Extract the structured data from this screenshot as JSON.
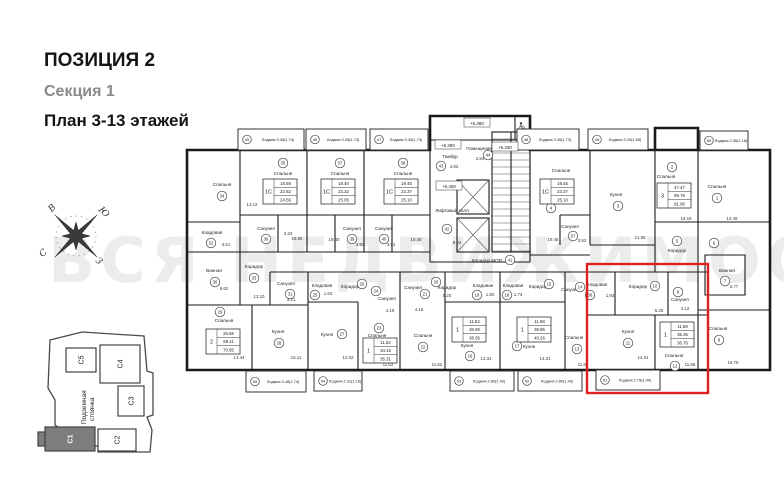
{
  "header": {
    "position": "ПОЗИЦИЯ 2",
    "section": "Секция 1",
    "plan_title": "План 3-13 этажей"
  },
  "watermark": "ВСЯ НЕДВИЖИМОСТЬ",
  "compass": {
    "north": "С",
    "east": "В",
    "south": "Ю",
    "west": "З"
  },
  "site_plan": {
    "parking_line1": "Подземная",
    "parking_line2": "стоянка",
    "highlighted": "С1",
    "sections": [
      {
        "id": "С5",
        "x": 66,
        "y": 348,
        "w": 30,
        "h": 24,
        "dark": false
      },
      {
        "id": "С4",
        "x": 100,
        "y": 345,
        "w": 40,
        "h": 38,
        "dark": false
      },
      {
        "id": "С3",
        "x": 118,
        "y": 386,
        "w": 26,
        "h": 30,
        "dark": false
      },
      {
        "id": "С2",
        "x": 98,
        "y": 429,
        "w": 38,
        "h": 22,
        "dark": false
      },
      {
        "id": "С1",
        "x": 45,
        "y": 427,
        "w": 50,
        "h": 24,
        "dark": true
      }
    ]
  },
  "plan": {
    "highlight_color": "#e02020",
    "loggia_word": "Лоджия",
    "highlight": {
      "x": 587,
      "y": 264,
      "w": 121,
      "h": 129
    },
    "elevations": [
      {
        "t": "+6.380",
        "x": 477,
        "y": 124
      },
      {
        "t": "+6.390",
        "x": 448,
        "y": 146
      },
      {
        "t": "+6.330",
        "x": 505,
        "y": 148
      },
      {
        "t": "+6.400",
        "x": 449,
        "y": 187
      }
    ],
    "rooms": [
      {
        "n": "Спальня",
        "tx": 222,
        "ty": 186,
        "m": "34",
        "cx": 222,
        "cy": 196
      },
      {
        "n": "Спальня",
        "tx": 283,
        "ty": 175,
        "m": "35",
        "cx": 283,
        "cy": 163
      },
      {
        "n": "Спальня",
        "tx": 340,
        "ty": 175,
        "m": "37",
        "cx": 340,
        "cy": 163
      },
      {
        "n": "Спальня",
        "tx": 403,
        "ty": 175,
        "m": "38",
        "cx": 403,
        "cy": 163
      },
      {
        "n": "Спальня",
        "tx": 561,
        "ty": 172,
        "m": "4",
        "cx": 551,
        "cy": 208
      },
      {
        "n": "Кухня",
        "tx": 616,
        "ty": 196,
        "m": "3",
        "cx": 618,
        "cy": 206
      },
      {
        "n": "Спальня",
        "tx": 666,
        "ty": 178,
        "m": "2",
        "cx": 672,
        "cy": 167
      },
      {
        "n": "Спальня",
        "tx": 717,
        "ty": 188,
        "m": "1",
        "cx": 717,
        "cy": 198
      },
      {
        "n": "Кладовая",
        "tx": 212,
        "ty": 234,
        "m": "32",
        "cx": 211,
        "cy": 243
      },
      {
        "n": "Ванная",
        "tx": 214,
        "ty": 272,
        "m": "30",
        "cx": 215,
        "cy": 282
      },
      {
        "n": "Коридор",
        "tx": 254,
        "ty": 268,
        "m": "33",
        "cx": 254,
        "cy": 278
      },
      {
        "n": "Санузел",
        "tx": 266,
        "ty": 230,
        "m": "36",
        "cx": 266,
        "cy": 239
      },
      {
        "n": "Санузел",
        "tx": 352,
        "ty": 230,
        "m": "39",
        "cx": 352,
        "cy": 239
      },
      {
        "n": "Санузел",
        "tx": 384,
        "ty": 230,
        "m": "40",
        "cx": 384,
        "cy": 239
      },
      {
        "n": "Санузел",
        "tx": 570,
        "ty": 228,
        "m": "57",
        "cx": 573,
        "cy": 236
      },
      {
        "n": "Тамбур",
        "tx": 450,
        "ty": 158,
        "m": "43",
        "cx": 441,
        "cy": 166
      },
      {
        "n": "Помещение",
        "tx": 479,
        "ty": 150,
        "m": "44",
        "cx": 488,
        "cy": 155
      },
      {
        "n": "Лифтовый холл",
        "tx": 452,
        "ty": 212,
        "m": "42",
        "cx": 447,
        "cy": 229
      },
      {
        "n": "Коридор МОП",
        "tx": 487,
        "ty": 262,
        "m": "41",
        "cx": 510,
        "cy": 260
      },
      {
        "n": "Коридор",
        "tx": 677,
        "ty": 252,
        "m": "5",
        "cx": 677,
        "cy": 241
      },
      {
        "n": "",
        "tx": 714,
        "ty": 240,
        "m": "6",
        "cx": 714,
        "cy": 243
      },
      {
        "n": "Ванная",
        "tx": 727,
        "ty": 272,
        "m": "7",
        "cx": 725,
        "cy": 281
      },
      {
        "n": "Спальня",
        "tx": 224,
        "ty": 322,
        "m": "29",
        "cx": 220,
        "cy": 312
      },
      {
        "n": "Кухня",
        "tx": 278,
        "ty": 333,
        "m": "28",
        "cx": 279,
        "cy": 343
      },
      {
        "n": "Санузел",
        "tx": 286,
        "ty": 285,
        "m": "31",
        "cx": 290,
        "cy": 294
      },
      {
        "n": "Кладовая",
        "tx": 322,
        "ty": 287,
        "m": "25",
        "cx": 315,
        "cy": 295
      },
      {
        "n": "Коридор",
        "tx": 350,
        "ty": 288,
        "m": "26",
        "cx": 362,
        "cy": 284
      },
      {
        "n": "Кухня",
        "tx": 327,
        "ty": 336,
        "m": "27",
        "cx": 342,
        "cy": 334
      },
      {
        "n": "Спальня",
        "tx": 377,
        "ty": 337,
        "m": "23",
        "cx": 379,
        "cy": 328
      },
      {
        "n": "Санузел",
        "tx": 387,
        "ty": 300,
        "m": "24",
        "cx": 376,
        "cy": 291
      },
      {
        "n": "Спальня",
        "tx": 423,
        "ty": 337,
        "m": "22",
        "cx": 423,
        "cy": 347
      },
      {
        "n": "Санузел",
        "tx": 413,
        "ty": 289,
        "m": "21",
        "cx": 425,
        "cy": 294
      },
      {
        "n": "Коридор",
        "tx": 447,
        "ty": 289,
        "m": "20",
        "cx": 436,
        "cy": 282
      },
      {
        "n": "Кладовая",
        "tx": 483,
        "ty": 287,
        "m": "19",
        "cx": 477,
        "cy": 295
      },
      {
        "n": "Кухня",
        "tx": 467,
        "ty": 347,
        "m": "18",
        "cx": 470,
        "cy": 356
      },
      {
        "n": "Кладовая",
        "tx": 513,
        "ty": 287,
        "m": "16",
        "cx": 507,
        "cy": 295
      },
      {
        "n": "Коридор",
        "tx": 538,
        "ty": 288,
        "m": "15",
        "cx": 549,
        "cy": 284
      },
      {
        "n": "Кухня",
        "tx": 529,
        "ty": 348,
        "m": "17",
        "cx": 517,
        "cy": 346
      },
      {
        "n": "Санузел",
        "tx": 570,
        "ty": 291,
        "m": "14",
        "cx": 580,
        "cy": 287
      },
      {
        "n": "Спальня",
        "tx": 574,
        "ty": 339,
        "m": "13",
        "cx": 577,
        "cy": 349
      },
      {
        "n": "Кладовая",
        "tx": 597,
        "ty": 286,
        "m": "56",
        "cx": 590,
        "cy": 295
      },
      {
        "n": "Коридор",
        "tx": 638,
        "ty": 288,
        "m": "10",
        "cx": 655,
        "cy": 286
      },
      {
        "n": "Санузел",
        "tx": 680,
        "ty": 301,
        "m": "9",
        "cx": 678,
        "cy": 292
      },
      {
        "n": "Кухня",
        "tx": 628,
        "ty": 333,
        "m": "11",
        "cx": 628,
        "cy": 343
      },
      {
        "n": "Спальня",
        "tx": 674,
        "ty": 357,
        "m": "12",
        "cx": 675,
        "cy": 366
      },
      {
        "n": "Спальня",
        "tx": 718,
        "ty": 330,
        "m": "8",
        "cx": 719,
        "cy": 340
      }
    ],
    "tables": [
      {
        "type": "1С",
        "rows": [
          "18.59",
          "22.82",
          "24.56"
        ],
        "x": 263,
        "y": 179
      },
      {
        "type": "1С",
        "rows": [
          "19.40",
          "23.32",
          "25.05"
        ],
        "x": 321,
        "y": 179
      },
      {
        "type": "1С",
        "rows": [
          "19.45",
          "23.37",
          "25.10"
        ],
        "x": 384,
        "y": 179
      },
      {
        "type": "1С",
        "rows": [
          "19.45",
          "23.37",
          "25.10"
        ],
        "x": 540,
        "y": 179
      },
      {
        "type": "3",
        "rows": [
          "47.47",
          "89.76",
          "91.95"
        ],
        "x": 657,
        "y": 183
      },
      {
        "type": "2",
        "rows": [
          "26.56",
          "69.11",
          "70.85"
        ],
        "x": 206,
        "y": 329
      },
      {
        "type": "1",
        "rows": [
          "11.52",
          "34.15",
          "35.31"
        ],
        "x": 363,
        "y": 338
      },
      {
        "type": "1",
        "rows": [
          "11.52",
          "36.96",
          "38.36"
        ],
        "x": 452,
        "y": 317
      },
      {
        "type": "1",
        "rows": [
          "11.68",
          "38.86",
          "40.26"
        ],
        "x": 517,
        "y": 317
      },
      {
        "type": "1",
        "rows": [
          "11.68",
          "35.36",
          "36.76"
        ],
        "x": 660,
        "y": 322
      }
    ],
    "loggias": [
      {
        "m": "45",
        "a": "3.48(1.74)",
        "x": 238,
        "y": 129,
        "w": 66,
        "h": 21
      },
      {
        "m": "46",
        "a": "3.45(1.73)",
        "x": 306,
        "y": 129,
        "w": 60,
        "h": 21
      },
      {
        "m": "47",
        "a": "3.45(1.73)",
        "x": 370,
        "y": 129,
        "w": 58,
        "h": 21
      },
      {
        "m": "48",
        "a": "3.45(1.73)",
        "x": 517,
        "y": 129,
        "w": 62,
        "h": 21
      },
      {
        "m": "49",
        "a": "3.29(1.65)",
        "x": 588,
        "y": 129,
        "w": 60,
        "h": 21
      },
      {
        "m": "50",
        "a": "2.36(1.18)",
        "x": 700,
        "y": 131,
        "w": 48,
        "h": 19
      },
      {
        "m": "55",
        "a": "3.48(1.74)",
        "x": 246,
        "y": 371,
        "w": 60,
        "h": 21
      },
      {
        "m": "54",
        "a": "2.31(1.16)",
        "x": 314,
        "y": 371,
        "w": 48,
        "h": 20
      },
      {
        "m": "53",
        "a": "2.80(1.40)",
        "x": 450,
        "y": 371,
        "w": 64,
        "h": 20
      },
      {
        "m": "52",
        "a": "2.80(1.40)",
        "x": 518,
        "y": 371,
        "w": 64,
        "h": 20
      },
      {
        "m": "51",
        "a": "2.79(1.40)",
        "x": 596,
        "y": 370,
        "w": 64,
        "h": 20
      }
    ],
    "dims": [
      {
        "t": "13.12",
        "x": 252,
        "y": 206
      },
      {
        "t": "4.51",
        "x": 226,
        "y": 246
      },
      {
        "t": "6.62",
        "x": 224,
        "y": 290
      },
      {
        "t": "13.10",
        "x": 259,
        "y": 298
      },
      {
        "t": "3.21",
        "x": 291,
        "y": 301
      },
      {
        "t": "4.23",
        "x": 288,
        "y": 235
      },
      {
        "t": "18.59",
        "x": 297,
        "y": 240
      },
      {
        "t": "19.40",
        "x": 334,
        "y": 241
      },
      {
        "t": "3.92",
        "x": 360,
        "y": 246
      },
      {
        "t": "3.92",
        "x": 391,
        "y": 246
      },
      {
        "t": "19.45",
        "x": 416,
        "y": 241
      },
      {
        "t": "4.82",
        "x": 454,
        "y": 168
      },
      {
        "t": "2.84",
        "x": 480,
        "y": 160
      },
      {
        "t": "8.92",
        "x": 457,
        "y": 244
      },
      {
        "t": "19.45",
        "x": 553,
        "y": 241
      },
      {
        "t": "3.92",
        "x": 582,
        "y": 242
      },
      {
        "t": "21.55",
        "x": 640,
        "y": 239
      },
      {
        "t": "16.19",
        "x": 686,
        "y": 220
      },
      {
        "t": "14.49",
        "x": 732,
        "y": 220
      },
      {
        "t": "3.77",
        "x": 734,
        "y": 288
      },
      {
        "t": "1.63",
        "x": 328,
        "y": 295
      },
      {
        "t": "1.82",
        "x": 490,
        "y": 296
      },
      {
        "t": "1.73",
        "x": 518,
        "y": 296
      },
      {
        "t": "1.93",
        "x": 610,
        "y": 297
      },
      {
        "t": "5.20",
        "x": 447,
        "y": 297
      },
      {
        "t": "5.25",
        "x": 659,
        "y": 312
      },
      {
        "t": "4.12",
        "x": 685,
        "y": 310
      },
      {
        "t": "4.19",
        "x": 390,
        "y": 312
      },
      {
        "t": "4.15",
        "x": 419,
        "y": 311
      },
      {
        "t": "13.44",
        "x": 239,
        "y": 359
      },
      {
        "t": "15.11",
        "x": 296,
        "y": 359
      },
      {
        "t": "12.02",
        "x": 348,
        "y": 359
      },
      {
        "t": "11.52",
        "x": 388,
        "y": 366
      },
      {
        "t": "11.52",
        "x": 437,
        "y": 366
      },
      {
        "t": "14.31",
        "x": 486,
        "y": 360
      },
      {
        "t": "14.31",
        "x": 545,
        "y": 360
      },
      {
        "t": "14.31",
        "x": 643,
        "y": 359
      },
      {
        "t": "11.68",
        "x": 583,
        "y": 366
      },
      {
        "t": "11.68",
        "x": 690,
        "y": 366
      },
      {
        "t": "16.79",
        "x": 733,
        "y": 364
      }
    ]
  }
}
